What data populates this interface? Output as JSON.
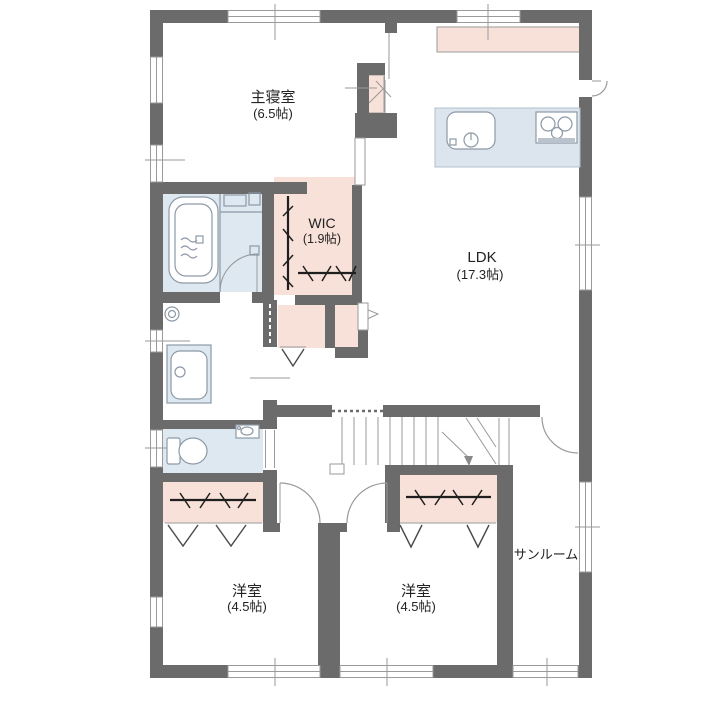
{
  "rooms": {
    "master_bedroom": {
      "label": "主寝室",
      "size": "(6.5帖)"
    },
    "wic": {
      "label": "WIC",
      "size": "(1.9帖)"
    },
    "ldk": {
      "label": "LDK",
      "size": "(17.3帖)"
    },
    "western_room_left": {
      "label": "洋室",
      "size": "(4.5帖)"
    },
    "western_room_center": {
      "label": "洋室",
      "size": "(4.5帖)"
    },
    "sunroom": {
      "label": "サンルーム"
    }
  },
  "colors": {
    "wall": "#6b6b6b",
    "storage_pink": "#f8e1d9",
    "wet_area_blue": "#dde8f1",
    "kitchen_island_blue": "#dce4ee",
    "thin_line": "#9a9a9a",
    "fixture_line": "#8d99a6",
    "hanger_rod": "#1f1f1f",
    "text": "#222222",
    "background": "#ffffff"
  },
  "icons": [
    "bathtub-icon",
    "shower-counter-icon",
    "vanity-sink-icon",
    "washer-drain-icon",
    "toilet-icon",
    "corner-sink-icon",
    "kitchen-sink-icon",
    "stove-icon",
    "kitchen-island",
    "kitchen-back-counter",
    "stairs",
    "stairs-down-arrow-icon",
    "hanger-rod-icon",
    "bifold-door-icon",
    "door-swing-icon",
    "window-icon"
  ]
}
